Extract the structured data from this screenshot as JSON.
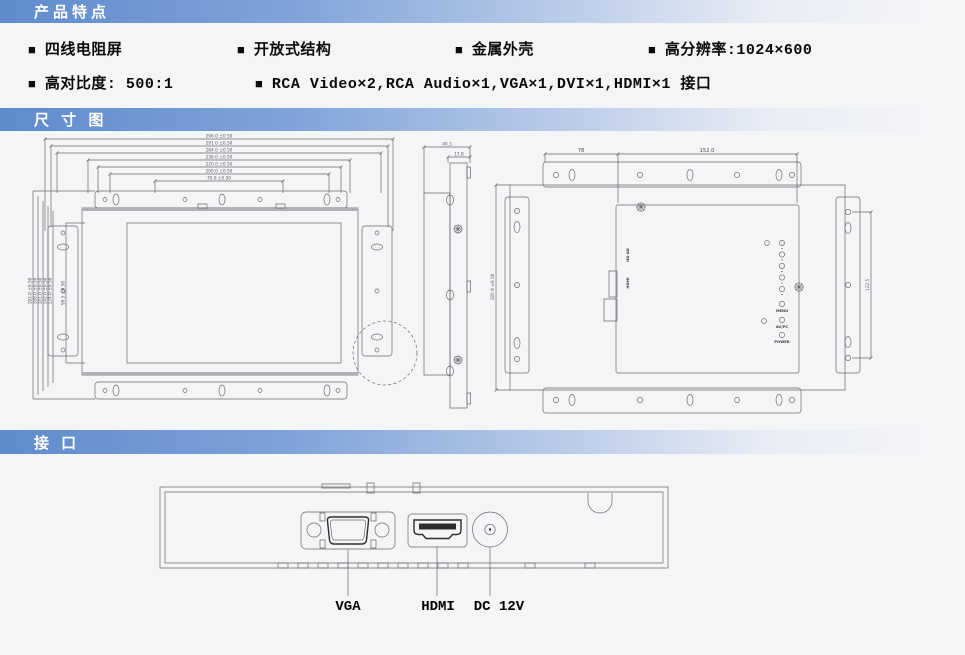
{
  "banners": {
    "product_features": "产品特点",
    "dimension_diagram": "尺 寸 图",
    "interface": "接 口"
  },
  "features": {
    "bullet": "■",
    "row1": [
      "四线电阻屏",
      "开放式结构",
      "金属外壳",
      "高分辨率:1024×600"
    ],
    "row2": [
      "高对比度: 500:1",
      "RCA Video×2,RCA Audio×1,VGA×1,DVI×1,HDMI×1 接口"
    ]
  },
  "dims": {
    "front_top": [
      "296.0 ±0.50",
      "291.0 ±0.50",
      "284.0 ±0.50",
      "236.0 ±0.50",
      "220.0 ±0.50",
      "200.0 ±0.50",
      "70.0 ±0.50"
    ],
    "front_left": [
      "193.0 ±0.50",
      "188.0 ±0.50",
      "181.0 ±0.50",
      "142.0 ±0.50",
      "124.0 ±0.50",
      "99.5 ±0.50"
    ],
    "side_depth": "40.3",
    "side_front_depth": "17.8",
    "rear_left_offset": "78",
    "rear_box_width": "152.0",
    "rear_height": "185.9 ±0.50",
    "rear_hole_pitch": "122.5"
  },
  "rear_labels": {
    "board": "HD-AD",
    "hdmi_port": "HDMI",
    "menu": "MENU",
    "av_pc": "AV/PC",
    "power": "POWER"
  },
  "port_labels": {
    "vga": "VGA",
    "hdmi": "HDMI",
    "dc": "DC 12V"
  },
  "colors": {
    "banner_blue": "#5f8bcd",
    "line_gray": "#6a6a6e"
  }
}
